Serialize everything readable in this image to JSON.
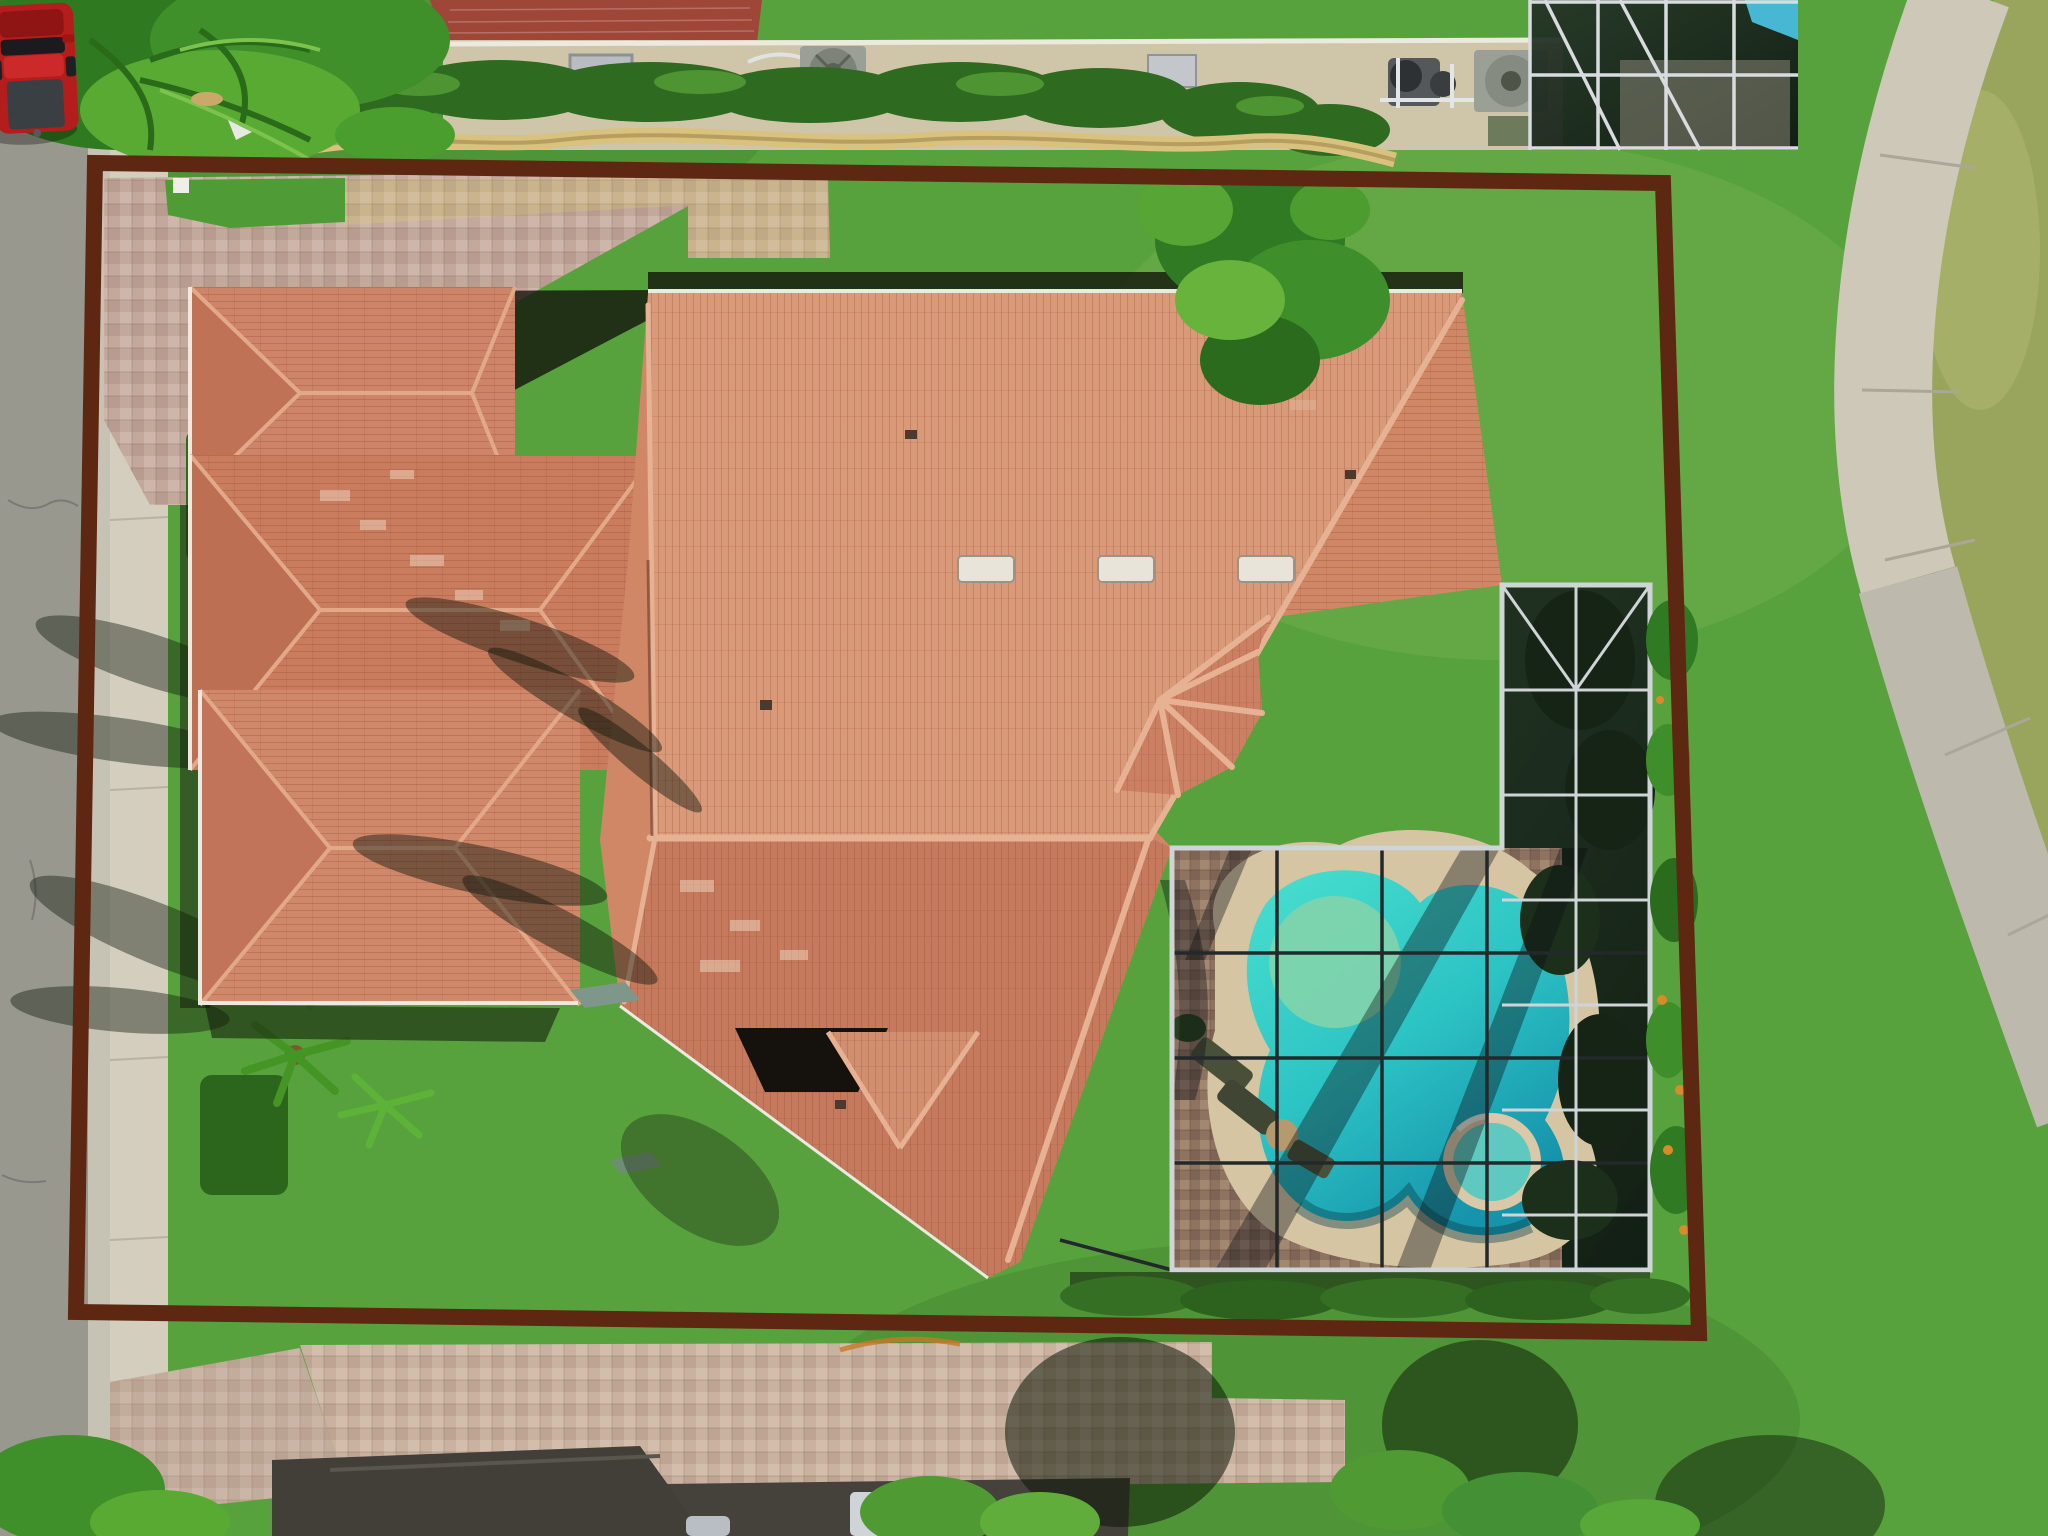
{
  "scene": {
    "kind": "aerial-drone-photograph",
    "subject": "single-family Mediterranean tile-roof house with screened pool enclosure and property boundary outline overlay",
    "view": "top-down nadir view",
    "visible_text": "none"
  },
  "boundary": {
    "shape": "slightly-skewed rectangle overlay",
    "stroke_width": 16,
    "corners": "95,163 1663,183 1699,1333 76,1312"
  },
  "colors": {
    "boundary": "#5e2712",
    "street": "#98988f",
    "gutter": "#c7c3b4",
    "sidewalk": "#d3cebe",
    "path_concrete": "#cdc8b8",
    "path_concrete_lower": "#bdb9ac",
    "lawn": "#58a23e",
    "lawn_rough": "#99a55c",
    "roof_light": "#d89a79",
    "roof_base": "#cf8766",
    "roof_dark": "#c57a5e",
    "roof_ridge": "#e7b294",
    "roof_pale": "#ecd0b8",
    "driveway_pavers": "#c3a89c",
    "walkway_tan": "#c9b48e",
    "driveway_bottom": "#c9b2a0",
    "apron_dark": "#45423b",
    "garage_roof": "#423f39",
    "pool_deck_pavers": "#8f7361",
    "deck_band": "#d6c5a3",
    "pool_shallow": "#82d4ab",
    "pool_water_top": "#49e0cf",
    "pool_water_deep": "#1694ac",
    "spa_water": "#5fc8bf",
    "cage_screen": "#1b2a1c",
    "cage_frame_light": "#cfd4d6",
    "cage_frame_dark": "#23282a",
    "hedge_dark": "#2e6b20",
    "foliage_bright": "#5db238",
    "wall_tan": "#cfc5a8",
    "pavers_red": "#9e4638",
    "equipment_gray": "#9aa096",
    "truck_red": "#b51c1c",
    "truck_bed": "#3a3f44",
    "shadow": "#141a0e"
  },
  "features": {
    "truck": "red pickup truck parked on street, top-left",
    "pool": "free-form turquoise pool with attached round spa inside dark screen enclosure",
    "ridge_vents_count": 3,
    "cage_grid_spacing_px": 105,
    "furniture": "lounge chairs and table on lanai pavers",
    "equipment": "neighbor pool pumps and AC fan units along top wall",
    "landscaping": "palms and hedges along left boundary, shrub bed along right of cage, round tree shadows bottom lawn"
  }
}
